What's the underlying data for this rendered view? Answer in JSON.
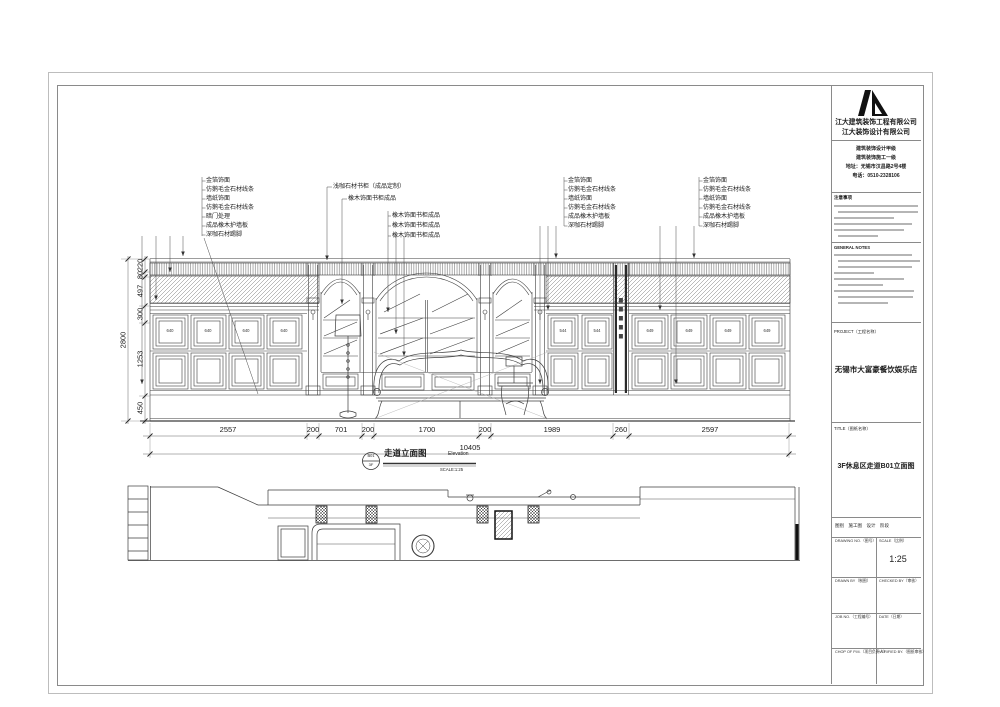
{
  "title_block": {
    "company_line1": "江大建筑装饰工程有限公司",
    "company_line2": "江大装饰设计有限公司",
    "credential_1": "建筑装饰设计甲级",
    "credential_2": "建筑装饰施工一级",
    "credential_3": "地址：无锡市汉昌路2号4楼",
    "credential_4": "电话：0510-2328106",
    "notes_cn_title": "注意事项",
    "notes_en_title": "GENERAL NOTES",
    "project_label": "PROJECT（工程名称）",
    "project_name": "无锡市大富豪餐饮娱乐店",
    "title_label": "TITLE（图纸名称）",
    "drawing_title": "3F休息区走道B01立面图",
    "stage_row": "图别　施工图　设计　阶段",
    "cells": {
      "drawing_no_label": "DRAWING NO.（图号）",
      "scale_label": "SCALE（比例）",
      "scale_value": "1:25",
      "drawn_by_label": "DRAWN BY（制图）",
      "checked_by_label": "CHECKED BY（审核）",
      "job_no_label": "JOB NO.（工程编号）",
      "date_label": "DATE（日期）",
      "chop_label": "CHOP OF P.M.（项目负责人）",
      "verified_label": "VERIFIED BY.（图纸审核）"
    }
  },
  "annotations": {
    "g1": [
      "金箔饰面",
      "仿鹅毛金石材线条",
      "墙纸饰面",
      "仿鹅毛金石材线条",
      "暗门处理",
      "成品橡木护墙板",
      "深咖石材踢脚"
    ],
    "g2": [
      "浅咖石材书柜（成品定制）",
      "橡木饰面书柜成品",
      "橡木饰面书柜成品",
      "橡木饰面书柜成品",
      "橡木饰面书柜成品"
    ],
    "g3": [
      "金箔饰面",
      "仿鹅毛金石材线条",
      "墙纸饰面",
      "仿鹅毛金石材线条",
      "成品橡木护墙板",
      "深咖石材踢脚"
    ],
    "g4": [
      "金箔饰面",
      "仿鹅毛金石材线条",
      "墙纸饰面",
      "仿鹅毛金石材线条",
      "成品橡木护墙板",
      "深咖石材踢脚"
    ]
  },
  "dimensions": {
    "horizontal": [
      "2557",
      "200",
      "701",
      "200",
      "1700",
      "200",
      "1989",
      "260",
      "2597"
    ],
    "horizontal_total": "10405",
    "vertical": [
      "220",
      "80",
      "497",
      "300",
      "1253",
      "450"
    ],
    "vertical_total": "2800"
  },
  "panel_labels": {
    "left": "640",
    "mid": "544",
    "right": "649"
  },
  "view_title": {
    "bubble_top": "B01",
    "bubble_bottom": "3F",
    "name": "走道立面图",
    "name_en": "Elevation",
    "scale": "SCALE:1:25"
  }
}
